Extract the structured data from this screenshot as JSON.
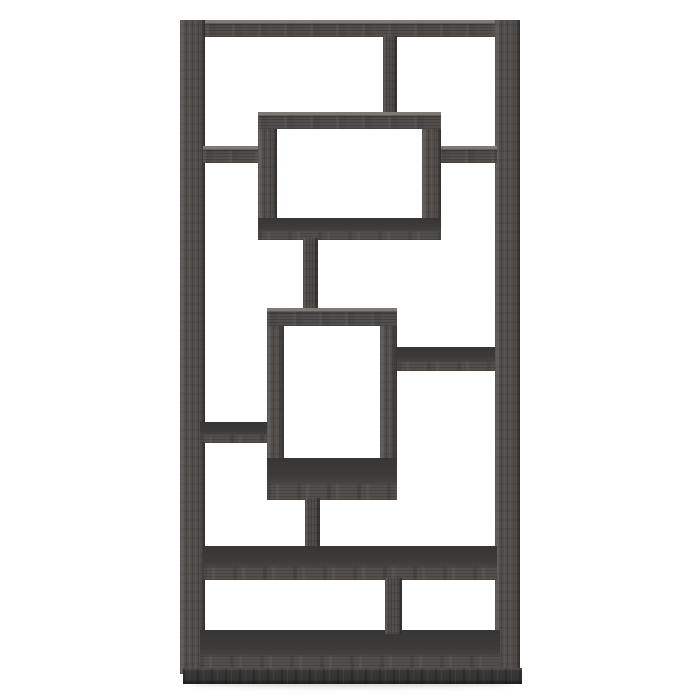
{
  "scene": {
    "description": "Product photo of a 10-shelf geometric bookcase with interlocking rectangular cubbies, weathered grey wood-grain finish, centered on a plain white background",
    "object": "geometric-cube-bookcase",
    "finish": "weathered-grey",
    "view": "front, slightly elevated camera"
  },
  "colors": {
    "bg": "#ffffff",
    "wood_front": "#514e4b",
    "wood_dark_top": "#3d3b39",
    "wood_deep": "#383634",
    "wood_light_edge": "#7d7a76",
    "shadow": "rgba(60,58,56,0.20)"
  },
  "parts": [
    {
      "name": "floor-shadow",
      "role": "shadow",
      "x": 188,
      "y": 678,
      "w": 326,
      "h": 9
    },
    {
      "name": "top-board",
      "role": "shelf",
      "x": 180,
      "y": 20,
      "w": 340,
      "h": 17
    },
    {
      "name": "left-side-panel",
      "role": "panel",
      "x": 180,
      "y": 20,
      "w": 25,
      "h": 654
    },
    {
      "name": "right-side-panel",
      "role": "panel",
      "x": 495,
      "y": 20,
      "w": 25,
      "h": 654
    },
    {
      "name": "bottom-board",
      "role": "topface",
      "x": 200,
      "y": 630,
      "w": 300,
      "h": 42
    },
    {
      "name": "base-kick",
      "role": "base",
      "x": 183,
      "y": 668,
      "w": 339,
      "h": 16
    },
    {
      "name": "top-center-divider",
      "role": "divider",
      "x": 383,
      "y": 36,
      "w": 14,
      "h": 78
    },
    {
      "name": "upper-left-shelf",
      "role": "shelf",
      "x": 203,
      "y": 146,
      "w": 58,
      "h": 17
    },
    {
      "name": "upper-right-shelf",
      "role": "shelf",
      "x": 439,
      "y": 146,
      "w": 58,
      "h": 17
    },
    {
      "name": "upper-box-left-wall",
      "role": "panel",
      "x": 258,
      "y": 112,
      "w": 19,
      "h": 128
    },
    {
      "name": "upper-box-right-wall",
      "role": "panel",
      "x": 422,
      "y": 112,
      "w": 19,
      "h": 128
    },
    {
      "name": "upper-box-top",
      "role": "shelf",
      "x": 258,
      "y": 112,
      "w": 183,
      "h": 17
    },
    {
      "name": "upper-box-bottom",
      "role": "topface",
      "x": 258,
      "y": 218,
      "w": 183,
      "h": 22
    },
    {
      "name": "upper-connector-post",
      "role": "divider",
      "x": 303,
      "y": 238,
      "w": 15,
      "h": 72
    },
    {
      "name": "lower-box-left-wall",
      "role": "panel",
      "x": 267,
      "y": 308,
      "w": 17,
      "h": 192
    },
    {
      "name": "lower-box-right-wall",
      "role": "panel",
      "x": 380,
      "y": 308,
      "w": 17,
      "h": 192
    },
    {
      "name": "lower-box-top",
      "role": "shelf",
      "x": 267,
      "y": 308,
      "w": 130,
      "h": 18
    },
    {
      "name": "lower-box-bottom",
      "role": "topface",
      "x": 267,
      "y": 458,
      "w": 130,
      "h": 42
    },
    {
      "name": "middle-right-shelf",
      "role": "topface",
      "x": 397,
      "y": 347,
      "w": 98,
      "h": 24
    },
    {
      "name": "middle-left-shelf",
      "role": "topface",
      "x": 200,
      "y": 422,
      "w": 67,
      "h": 21
    },
    {
      "name": "lower-connector-post",
      "role": "divider",
      "x": 305,
      "y": 498,
      "w": 15,
      "h": 52
    },
    {
      "name": "wide-lower-shelf",
      "role": "topface",
      "x": 203,
      "y": 546,
      "w": 294,
      "h": 34
    },
    {
      "name": "bottom-right-divider",
      "role": "divider",
      "x": 385,
      "y": 578,
      "w": 17,
      "h": 56
    }
  ]
}
